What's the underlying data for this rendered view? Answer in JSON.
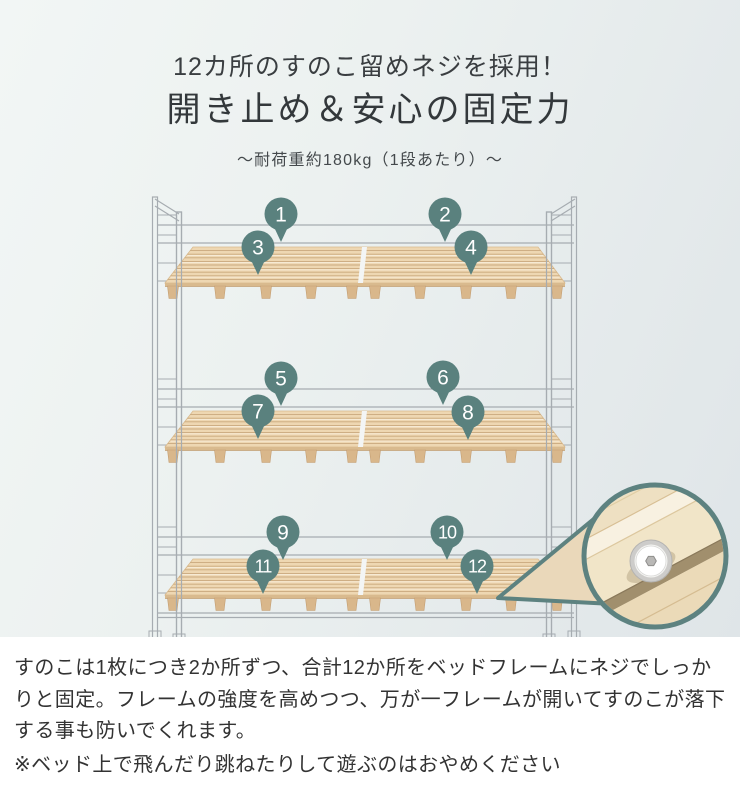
{
  "header": {
    "title_line1": "12カ所のすのこ留めネジを採用！",
    "title_line2": "開き止め＆安心の固定力",
    "subtitle": "～耐荷重約180kg（1段あたり）～"
  },
  "illustration": {
    "alt": "3-tier bed frame with slatted wood boards and 12 numbered screw-position markers, with magnified close-up of a fixing screw",
    "marker_color": "#5a817e",
    "marker_text_color": "#ffffff",
    "wood_color": "#eed7b2",
    "wood_line_color": "#c9a87d",
    "wood_edge_color": "#d9ba8e",
    "frame_line_color": "#a6acb1",
    "magnifier_border_color": "#5d8280",
    "markers": [
      {
        "label": "1",
        "x": 281,
        "y": 214
      },
      {
        "label": "2",
        "x": 445,
        "y": 214
      },
      {
        "label": "3",
        "x": 258,
        "y": 247
      },
      {
        "label": "4",
        "x": 471,
        "y": 247
      },
      {
        "label": "5",
        "x": 281,
        "y": 378
      },
      {
        "label": "6",
        "x": 443,
        "y": 377
      },
      {
        "label": "7",
        "x": 258,
        "y": 411
      },
      {
        "label": "8",
        "x": 468,
        "y": 412
      },
      {
        "label": "9",
        "x": 283,
        "y": 532
      },
      {
        "label": "10",
        "x": 447,
        "y": 532
      },
      {
        "label": "11",
        "x": 263,
        "y": 566
      },
      {
        "label": "12",
        "x": 477,
        "y": 566
      }
    ]
  },
  "description": {
    "body": "すのこは1枚につき2か所ずつ、合計12か所をベッドフレームにネジでしっかりと固定。フレームの強度を高めつつ、万が一フレームが開いてすのこが落下する事も防いでくれます。",
    "note": "※ベッド上で飛んだり跳ねたりして遊ぶのはおやめください"
  }
}
